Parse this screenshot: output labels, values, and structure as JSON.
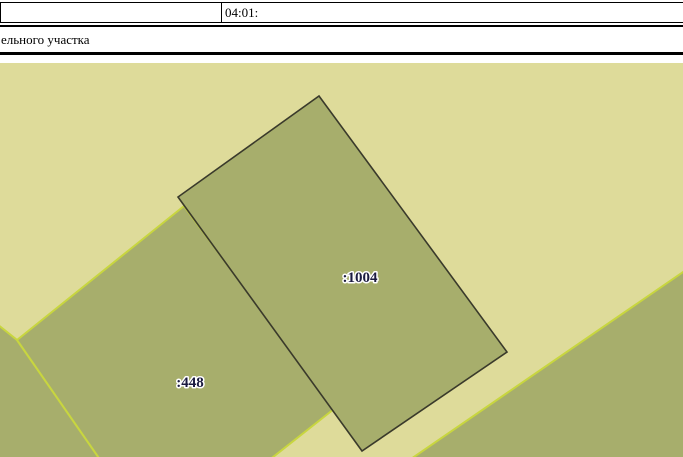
{
  "header": {
    "cadastral_number": "04:01:",
    "title_fragment": "ельного участка"
  },
  "map": {
    "colors": {
      "background": "#dedb9a",
      "parcel_fill": "#a7ae6c",
      "bright_border": "#c8d63f",
      "dark_border": "#3a3a2b",
      "label_text": "#1b1b40",
      "label_halo": "#ffffff"
    },
    "parcels": [
      {
        "name": "corner-parcel-southwest",
        "points": "-3,261 17,277 101,398 -3,398"
      },
      {
        "name": "parcel-448",
        "label": ":448",
        "points": "17,277 184,143 334,346 268,398 101,398"
      },
      {
        "name": "parcel-southeast",
        "points": "686,207 408,398 686,398"
      },
      {
        "name": "parcel-1004",
        "label": ":1004",
        "points": "319,33 507,289 362,388 178,134"
      }
    ],
    "labels": [
      {
        "text": ":1004"
      },
      {
        "text": ":448"
      }
    ]
  }
}
